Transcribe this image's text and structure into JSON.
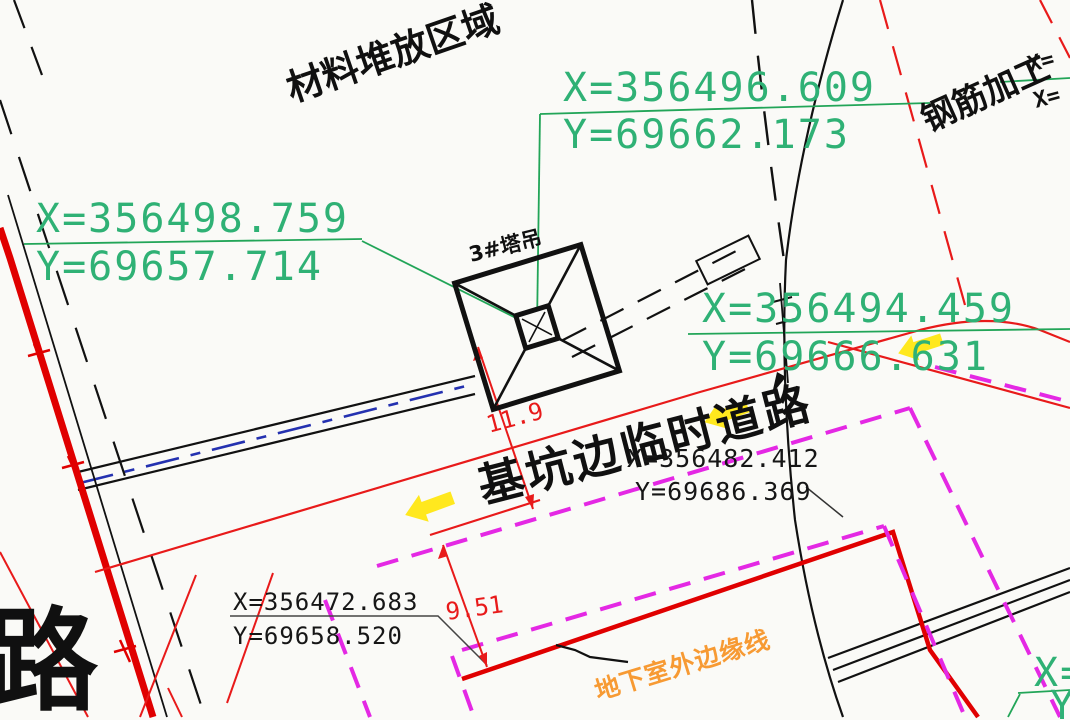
{
  "drawing": {
    "title_hint": "construction site plan (CAD)",
    "areas": {
      "material": "材料堆放区域",
      "rebar": "钢筋加工"
    },
    "crane": {
      "label": "3#塔吊"
    },
    "road": {
      "label": "基坑边临时道路"
    },
    "basement": {
      "label": "地下室外边缘线"
    },
    "road_char": "路",
    "coords": {
      "top": {
        "x": "X=356496.609",
        "y": "Y=69662.173"
      },
      "left": {
        "x": "X=356498.759",
        "y": "Y=69657.714"
      },
      "right": {
        "x": "X=356494.459",
        "y": "Y=69666.631"
      },
      "road": {
        "x": "X=356482.412",
        "y": "Y=69686.369"
      },
      "bottom": {
        "x": "X=356472.683",
        "y": "Y=69658.520"
      },
      "corner_br": {
        "x": "X=",
        "y": "Y="
      },
      "corner_tr": {
        "x1": "X=",
        "x2": "X="
      }
    },
    "dims": {
      "road_to_pit": "11.9",
      "pit_to_basement": "9.51"
    },
    "colors": {
      "green_text": "#2fb175",
      "green_line": "#22a558",
      "red": "#e81a1a",
      "thick_red": "#e00000",
      "magenta": "#e428e4",
      "orange": "#f79a33",
      "blue": "#2431b0",
      "yellow": "#ffe81e",
      "black": "#111111"
    }
  }
}
